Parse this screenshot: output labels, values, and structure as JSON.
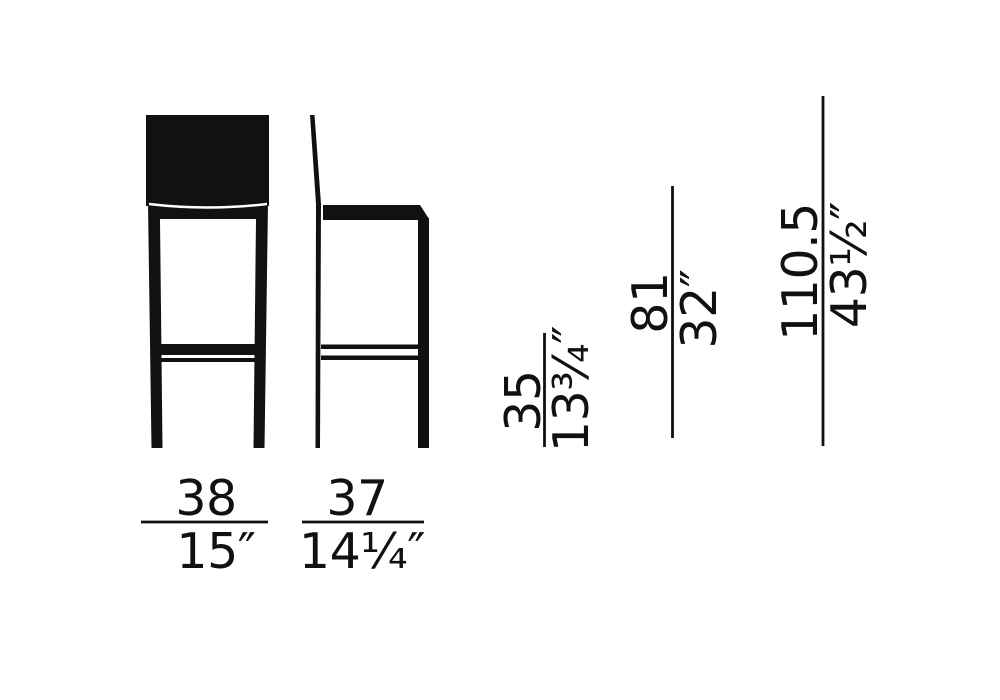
{
  "canvas": {
    "background": "#ffffff",
    "ink": "#111111"
  },
  "dimensions": {
    "bottom": [
      {
        "name": "front-width",
        "metric": "38",
        "imperial": "15″"
      },
      {
        "name": "side-depth",
        "metric": "37",
        "imperial": "14¼″"
      }
    ],
    "vertical": [
      {
        "name": "first-height",
        "metric": "35",
        "imperial": "13¾″"
      },
      {
        "name": "second-height",
        "metric": "81",
        "imperial": "32″"
      },
      {
        "name": "overall-height",
        "metric": "110.5",
        "imperial": "43½″"
      }
    ]
  }
}
